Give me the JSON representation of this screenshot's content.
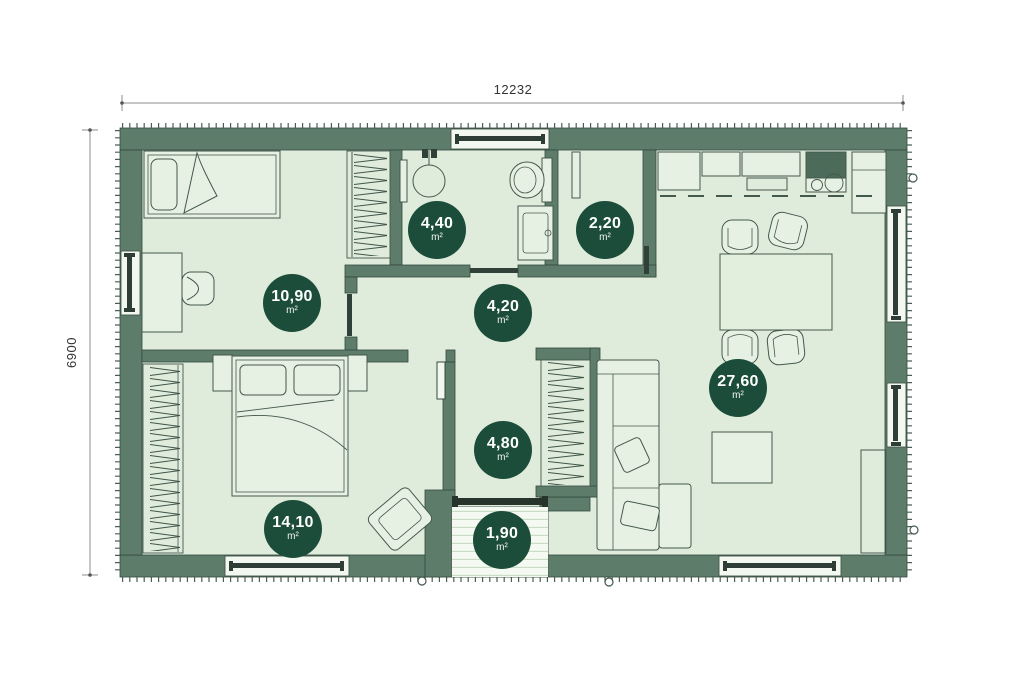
{
  "plan": {
    "dimensions": {
      "width_label": "12232",
      "height_label": "6900"
    },
    "unit": "m²",
    "rooms": [
      {
        "id": "bathroom",
        "area": "4,40"
      },
      {
        "id": "wc",
        "area": "2,20"
      },
      {
        "id": "bedroom-1",
        "area": "10,90"
      },
      {
        "id": "hallway",
        "area": "4,20"
      },
      {
        "id": "living-room",
        "area": "27,60"
      },
      {
        "id": "corridor",
        "area": "4,80"
      },
      {
        "id": "bedroom-2",
        "area": "14,10"
      },
      {
        "id": "entrance",
        "area": "1,90"
      }
    ],
    "colors": {
      "wall": "#5d7c6a",
      "floor": "#dfecdb",
      "badge": "#1b4d3a",
      "line": "#44584d"
    }
  }
}
